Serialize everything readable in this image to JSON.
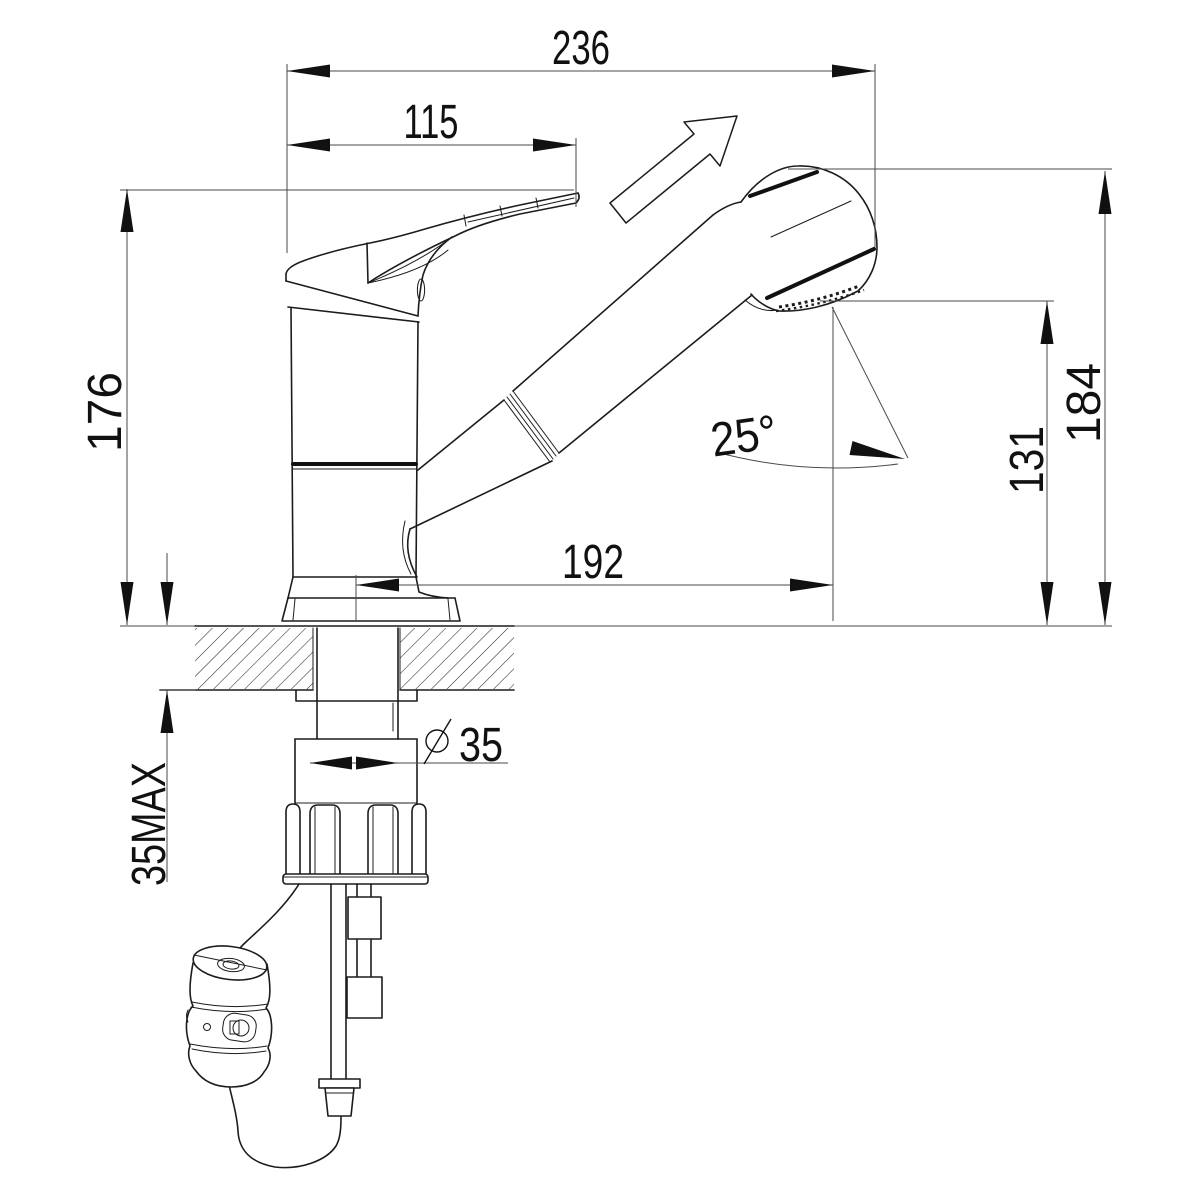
{
  "drawing": {
    "background": "#ffffff",
    "line_color": "#1c1c1c",
    "dim_line_color": "#4a4a4a",
    "text_color": "#111111",
    "dimensions": {
      "overall_projection": "236",
      "handle_reach": "115",
      "height_to_handle": "176",
      "height_to_spray_top": "184",
      "height_to_outlet": "131",
      "spout_reach": "192",
      "spray_angle": "25°",
      "mounting_hole_diameter": "35",
      "max_counter_thickness": "35MAX"
    },
    "icons": {
      "diameter_symbol": "circle-slash",
      "pullout_direction": "hollow-arrow-up-right"
    }
  }
}
